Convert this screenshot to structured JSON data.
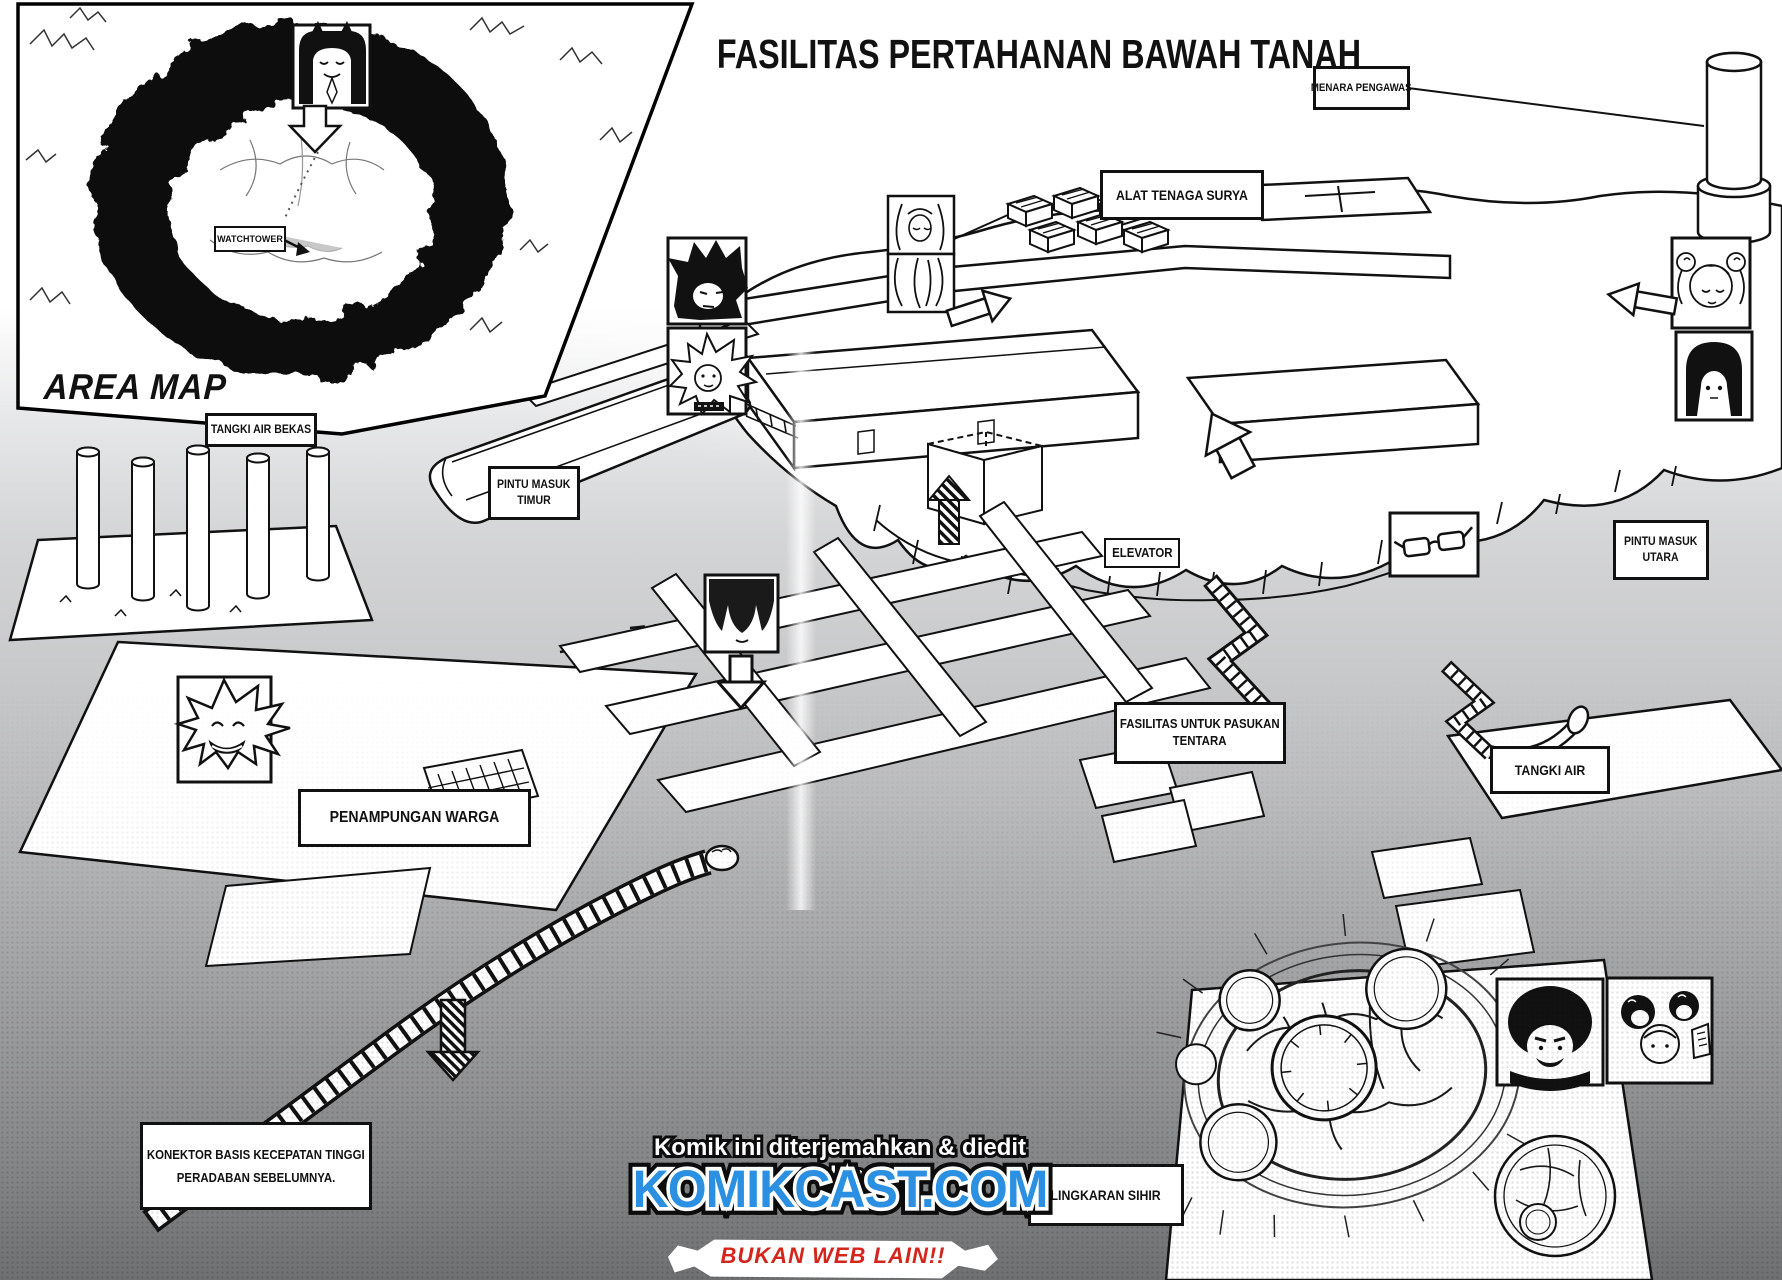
{
  "page": {
    "title": "FASILITAS PERTAHANAN BAWAH TANAH"
  },
  "area_map": {
    "caption": "AREA MAP",
    "watchtower_label": "WATCHTOWER"
  },
  "labels": {
    "menara_pengawas": "MENARA PENGAWAS",
    "alat_tenaga_surya": "ALAT TENAGA SURYA",
    "tangki_air_bekas": "TANGKI AIR BEKAS",
    "pintu_masuk_timur_line1": "PINTU MASUK",
    "pintu_masuk_timur_line2": "TIMUR",
    "elevator": "ELEVATOR",
    "pintu_masuk_utara_line1": "PINTU MASUK",
    "pintu_masuk_utara_line2": "UTARA",
    "fasilitas_pasukan_line1": "FASILITAS UNTUK PASUKAN",
    "fasilitas_pasukan_line2": "TENTARA",
    "tangki_air": "TANGKI AIR",
    "penampungan_warga": "PENAMPUNGAN WARGA",
    "konektor_line1": "KONEKTOR BASIS KECEPATAN TINGGI",
    "konektor_line2": "PERADABAN SEBELUMNYA.",
    "lingkaran_sihir": "LINGKARAN SIHIR"
  },
  "watermark": {
    "credit": "Komik ini diterjemahkan & diedit oleh",
    "site": "KOMIKCAST.COM",
    "tagline": "BUKAN WEB LAIN!!"
  },
  "colors": {
    "ink": "#111111",
    "komikcast_blue": "#2b8fe2",
    "tagline_red": "#d3251c"
  }
}
